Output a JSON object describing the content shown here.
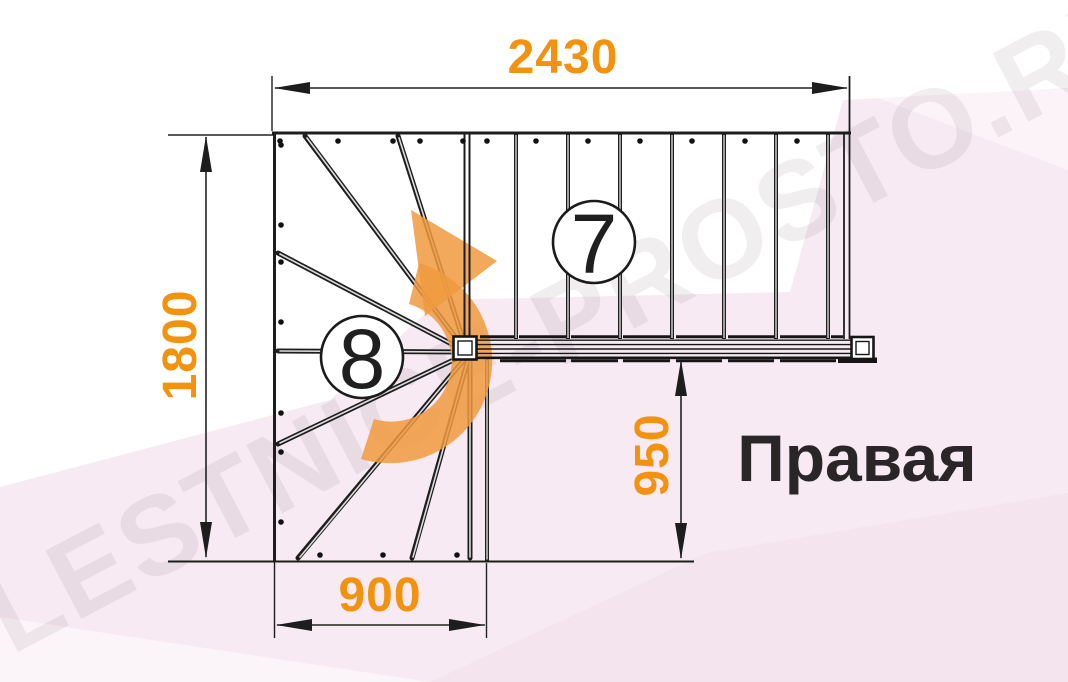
{
  "drawing": {
    "watermark": "LESTNICE-PROSTO.RU",
    "stair_type_label": "Правая",
    "dimensions": {
      "top_width_mm": "2430",
      "left_depth_mm": "1800",
      "winder_width_mm": "900",
      "flight_offset_mm": "950"
    },
    "step_counts": {
      "straight_flight": "7",
      "winder": "8"
    },
    "icons": {
      "direction_arrow": "curved-right-turn-arrow"
    },
    "colors": {
      "dimension_text": "#f2920e",
      "arrow_orange": "#f09a3e",
      "line_black": "#1d1d1d",
      "pink_background": "#f7eaf2"
    }
  }
}
